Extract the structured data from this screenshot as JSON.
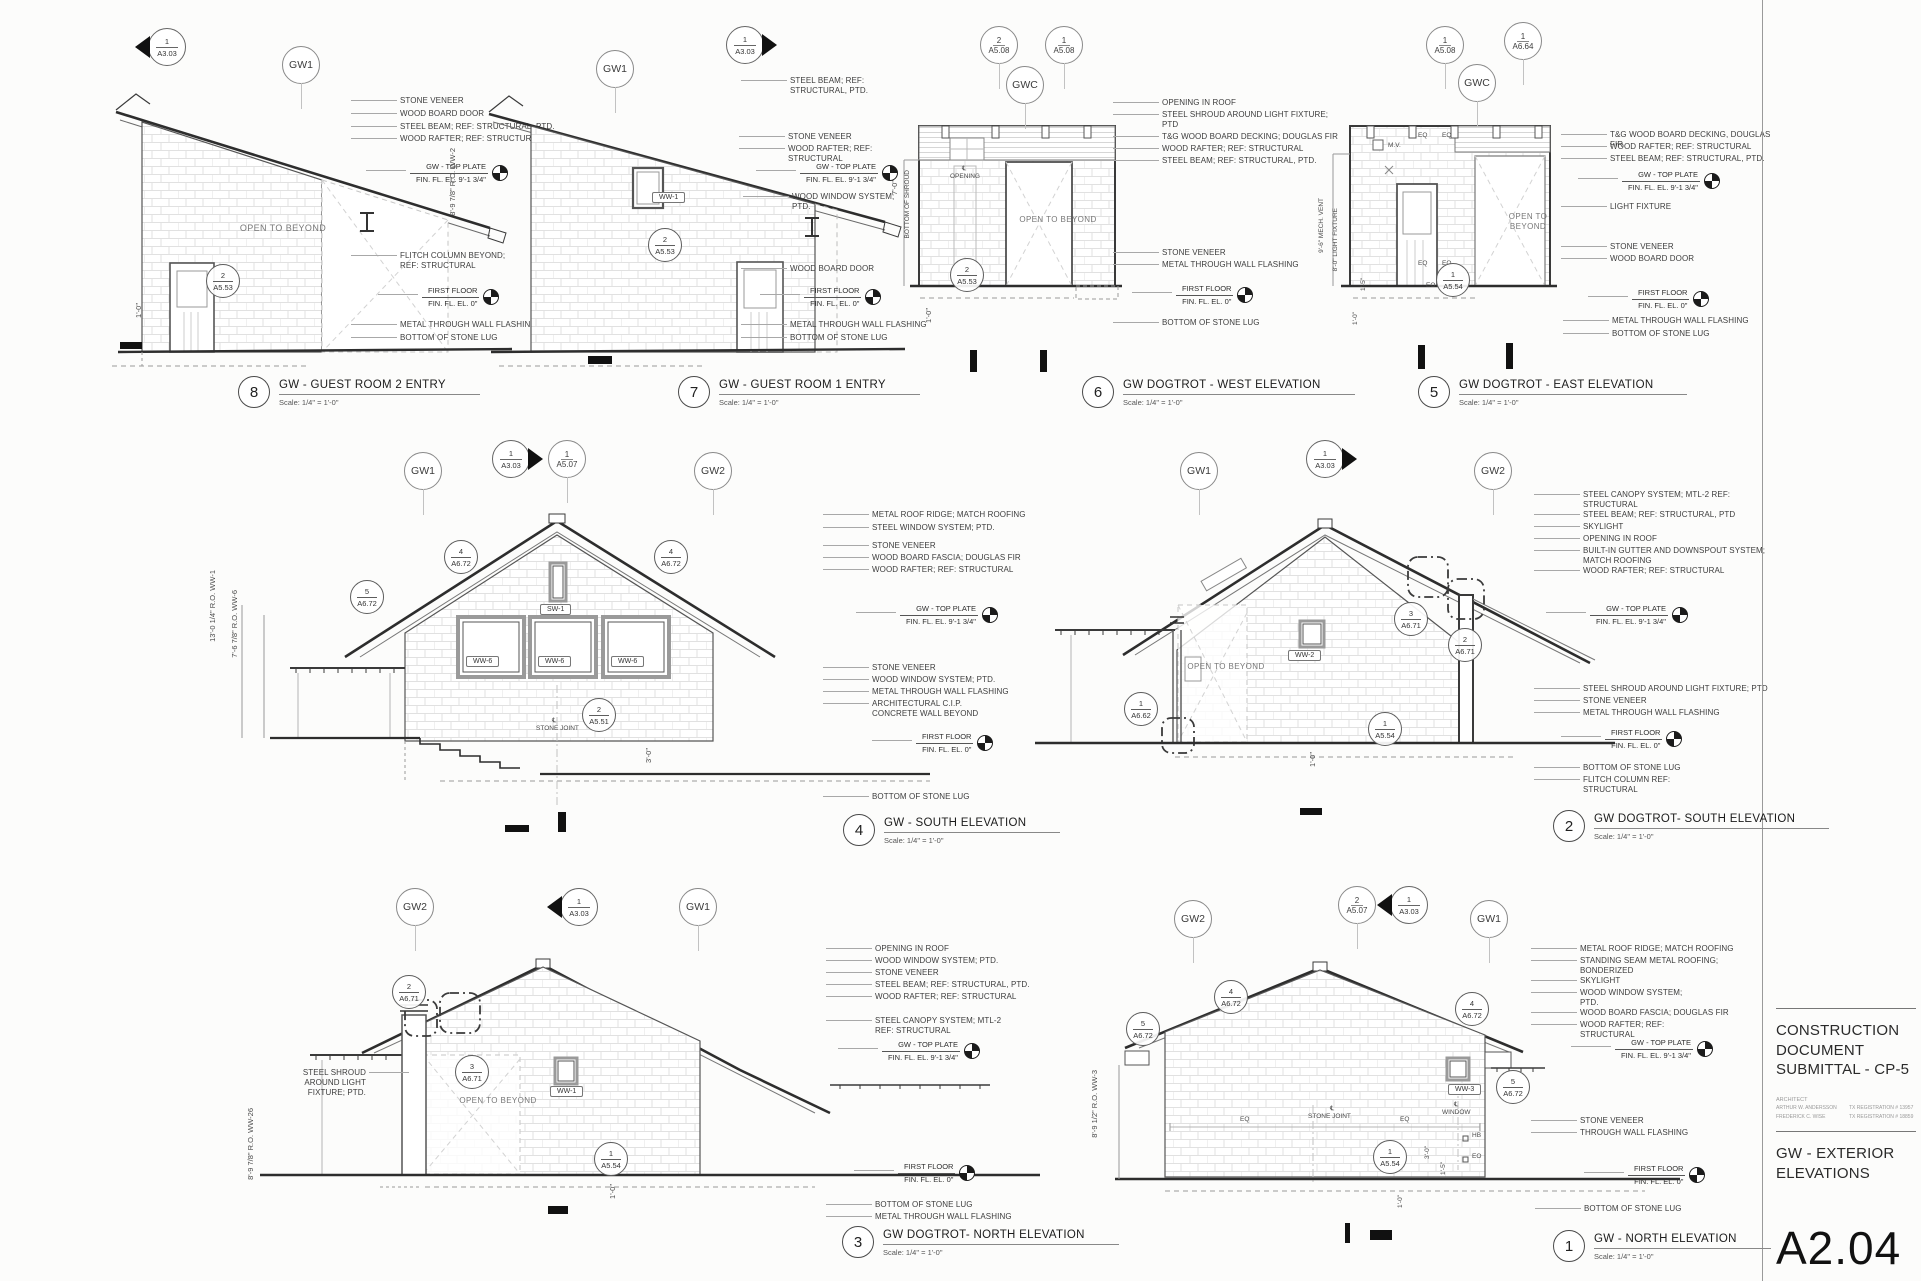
{
  "lv": {
    "tp1": "GW - TOP PLATE",
    "tp2": "FIN. FL. EL. 9'-1 3/4\"",
    "ff1": "FIRST FLOOR",
    "ff2": "FIN. FL. EL. 0\""
  },
  "tb": {
    "heading": "CONSTRUCTION DOCUMENT SUBMITTAL - CP-5",
    "arch_label": "ARCHITECT",
    "arch1": "ARTHUR W. ANDERSSON",
    "reg1": "TX REGISTRATION # 13957",
    "arch2": "FREDERICK C. WISE",
    "reg2": "TX REGISTRATION # 18859",
    "sheet_title": "GW - EXTERIOR ELEVATIONS",
    "sheet_number": "A2.04"
  },
  "e8": {
    "num": "8",
    "title": "GW - GUEST ROOM 2 ENTRY",
    "scale": "Scale:  1/4\" = 1'-0\"",
    "g1": "GW1",
    "mk": {
      "n": "1",
      "s": "A3.03"
    },
    "a": [
      "STONE VENEER",
      "WOOD BOARD DOOR",
      "STEEL BEAM; REF: STRUCTURAL, PTD.",
      "WOOD RAFTER; REF: STRUCTURAL"
    ],
    "b": [
      "FLITCH COLUMN BEYOND; REF: STRUCTURAL"
    ],
    "c": [
      "METAL THROUGH WALL FLASHING",
      "BOTTOM OF STONE LUG"
    ],
    "k1": {
      "n": "2",
      "s": "A5.53"
    },
    "lbl": {
      "open": "OPEN TO BEYOND",
      "d1": "1'-0\""
    }
  },
  "e7": {
    "num": "7",
    "title": "GW - GUEST ROOM 1 ENTRY",
    "scale": "Scale:  1/4\" = 1'-0\"",
    "g1": "GW1",
    "mk": {
      "n": "1",
      "s": "A3.03"
    },
    "t": [
      "STEEL BEAM; REF: STRUCTURAL, PTD."
    ],
    "a": [
      "STONE VENEER",
      "WOOD RAFTER; REF: STRUCTURAL"
    ],
    "b": [
      "WOOD WINDOW SYSTEM; PTD."
    ],
    "c": [
      "WOOD BOARD DOOR"
    ],
    "d": [
      "METAL THROUGH WALL FLASHING",
      "BOTTOM OF STONE LUG"
    ],
    "k1": {
      "n": "2",
      "s": "A5.53"
    },
    "lbl": {
      "w": "WW-1",
      "vd": "8'-9 7/8\" R.O.  WW-2"
    }
  },
  "e6": {
    "num": "6",
    "title": "GW DOGTROT - WEST ELEVATION",
    "scale": "Scale:  1/4\" = 1'-0\"",
    "g1": "GWC",
    "bb1": {
      "n": "2",
      "s": "A5.08"
    },
    "bb2": {
      "n": "1",
      "s": "A5.08"
    },
    "a": [
      "OPENING IN ROOF",
      "STEEL SHROUD AROUND LIGHT FIXTURE; PTD"
    ],
    "b": [
      "T&G WOOD BOARD DECKING; DOUGLAS FIR",
      "WOOD RAFTER; REF: STRUCTURAL",
      "STEEL BEAM; REF: STRUCTURAL, PTD."
    ],
    "c": [
      "STONE VENEER",
      "METAL THROUGH WALL FLASHING"
    ],
    "d": [
      "BOTTOM OF STONE LUG"
    ],
    "k1": {
      "n": "2",
      "s": "A5.53"
    },
    "lbl": {
      "open": "OPEN TO BEYOND",
      "cl": "℄",
      "opening": "OPENING",
      "shroud": "BOTTOM OF SHROUD",
      "d1": "7'-0\"",
      "d2": "1'-0\""
    }
  },
  "e5": {
    "num": "5",
    "title": "GW DOGTROT - EAST ELEVATION",
    "scale": "Scale:  1/4\" = 1'-0\"",
    "g1": "GWC",
    "bb1": {
      "n": "1",
      "s": "A5.08"
    },
    "bb2": {
      "n": "1",
      "s": "A6.64"
    },
    "a": [
      "T&G WOOD BOARD DECKING, DOUGLAS FIR",
      "WOOD RAFTER; REF: STRUCTURAL",
      "STEEL BEAM; REF: STRUCTURAL, PTD."
    ],
    "b": [
      "LIGHT FIXTURE"
    ],
    "c": [
      "STONE VENEER",
      "WOOD BOARD DOOR"
    ],
    "d": [
      "METAL THROUGH WALL FLASHING",
      "BOTTOM OF STONE LUG"
    ],
    "k1": {
      "n": "1",
      "s": "A5.54"
    },
    "lbl": {
      "open": "OPEN TO BEYOND",
      "eq": "EQ",
      "mv": "M.V.",
      "eo": "EO",
      "d1": "9'-6\" MECH. VENT",
      "d2": "8'-0\" LIGHT FIXTURE",
      "d3": "1'-5\"",
      "d4": "1'-0\""
    }
  },
  "e4": {
    "num": "4",
    "title": "GW - SOUTH ELEVATION",
    "scale": "Scale:  1/4\" = 1'-0\"",
    "g1": "GW1",
    "g2": "GW2",
    "mk": {
      "n": "1",
      "s": "A3.03"
    },
    "bb1": {
      "n": "1",
      "s": "A5.07"
    },
    "a": [
      "METAL ROOF RIDGE; MATCH ROOFING",
      "STEEL WINDOW SYSTEM; PTD."
    ],
    "b": [
      "STONE VENEER",
      "WOOD BOARD FASCIA; DOUGLAS FIR",
      "WOOD RAFTER; REF: STRUCTURAL"
    ],
    "c": [
      "STONE VENEER",
      "WOOD WINDOW SYSTEM; PTD.",
      "METAL THROUGH WALL FLASHING",
      "ARCHITECTURAL C.I.P. CONCRETE WALL BEYOND"
    ],
    "d": [
      "BOTTOM OF STONE LUG"
    ],
    "k1": {
      "n": "5",
      "s": "A6.72"
    },
    "k2": {
      "n": "4",
      "s": "A6.72"
    },
    "k3": {
      "n": "4",
      "s": "A6.72"
    },
    "k4": {
      "n": "2",
      "s": "A5.51"
    },
    "lbl": {
      "w": "WW-6",
      "sw": "SW-1",
      "cl": "℄",
      "joint": "STONE JOINT",
      "vd1": "13'-0 1/4\" R.O.  WW-1",
      "vd2": "7'-6 7/8\" R.O.  WW-6",
      "d1": "3'-0\""
    }
  },
  "e2": {
    "num": "2",
    "title": "GW DOGTROT- SOUTH ELEVATION",
    "scale": "Scale:  1/4\" = 1'-0\"",
    "g1": "GW1",
    "g2": "GW2",
    "mk": {
      "n": "1",
      "s": "A3.03"
    },
    "a": [
      "STEEL CANOPY SYSTEM; MTL-2 REF: STRUCTURAL",
      "STEEL BEAM; REF: STRUCTURAL, PTD",
      "SKYLIGHT",
      "OPENING IN ROOF",
      "BUILT-IN GUTTER AND DOWNSPOUT SYSTEM; MATCH ROOFING",
      "WOOD RAFTER; REF: STRUCTURAL"
    ],
    "b": [
      "STEEL SHROUD AROUND LIGHT FIXTURE; PTD",
      "STONE VENEER",
      "METAL THROUGH WALL FLASHING"
    ],
    "c": [
      "BOTTOM OF STONE LUG",
      "FLITCH COLUMN REF: STRUCTURAL"
    ],
    "k1": {
      "n": "3",
      "s": "A6.71"
    },
    "k2": {
      "n": "2",
      "s": "A6.71"
    },
    "k3": {
      "n": "1",
      "s": "A6.62"
    },
    "k4": {
      "n": "1",
      "s": "A5.54"
    },
    "lbl": {
      "open": "OPEN TO BEYOND",
      "w": "WW-2",
      "d1": "1'-0\""
    }
  },
  "e3": {
    "num": "3",
    "title": "GW DOGTROT- NORTH ELEVATION",
    "scale": "Scale:  1/4\" = 1'-0\"",
    "g1": "GW2",
    "g2": "GW1",
    "mk": {
      "n": "1",
      "s": "A3.03"
    },
    "left": "STEEL SHROUD AROUND LIGHT FIXTURE; PTD.",
    "a": [
      "OPENING IN ROOF",
      "WOOD WINDOW SYSTEM; PTD.",
      "STONE VENEER",
      "STEEL BEAM; REF: STRUCTURAL, PTD.",
      "WOOD RAFTER; REF: STRUCTURAL"
    ],
    "b": [
      "STEEL CANOPY SYSTEM; MTL-2 REF: STRUCTURAL"
    ],
    "c": [
      "BOTTOM OF STONE LUG",
      "METAL THROUGH WALL FLASHING"
    ],
    "k1": {
      "n": "2",
      "s": "A6.71"
    },
    "k2": {
      "n": "3",
      "s": "A6.71"
    },
    "k3": {
      "n": "1",
      "s": "A5.54"
    },
    "lbl": {
      "open": "OPEN TO BEYOND",
      "w": "WW-1",
      "d1": "1'-0\"",
      "vd": "8'-9 7/8\" R.O.  WW-26"
    }
  },
  "e1": {
    "num": "1",
    "title": "GW - NORTH ELEVATION",
    "scale": "Scale:  1/4\" = 1'-0\"",
    "g1": "GW2",
    "g2": "GW1",
    "mk": {
      "n": "1",
      "s": "A3.03"
    },
    "bb1": {
      "n": "2",
      "s": "A5.07"
    },
    "a": [
      "METAL ROOF RIDGE; MATCH ROOFING",
      "STANDING SEAM METAL ROOFING; BONDERIZED",
      "SKYLIGHT",
      "WOOD WINDOW SYSTEM; PTD.",
      "WOOD BOARD FASCIA; DOUGLAS FIR",
      "WOOD RAFTER; REF: STRUCTURAL"
    ],
    "b": [
      "STONE VENEER",
      "THROUGH WALL FLASHING"
    ],
    "c": [
      "BOTTOM OF STONE LUG"
    ],
    "k1": {
      "n": "5",
      "s": "A6.72"
    },
    "k2": {
      "n": "4",
      "s": "A6.72"
    },
    "k3": {
      "n": "4",
      "s": "A6.72"
    },
    "k4": {
      "n": "5",
      "s": "A6.72"
    },
    "k5": {
      "n": "1",
      "s": "A5.54"
    },
    "lbl": {
      "w": "WW-3",
      "cl": "℄",
      "window": "WINDOW",
      "joint": "STONE JOINT",
      "eq": "EQ",
      "hb": "HB",
      "eo": "EO",
      "d1": "3'-0\"",
      "d2": "1'-5\"",
      "d3": "1'-0\"",
      "vd": "8'-9 1/2\" R.O.  WW-3"
    }
  }
}
